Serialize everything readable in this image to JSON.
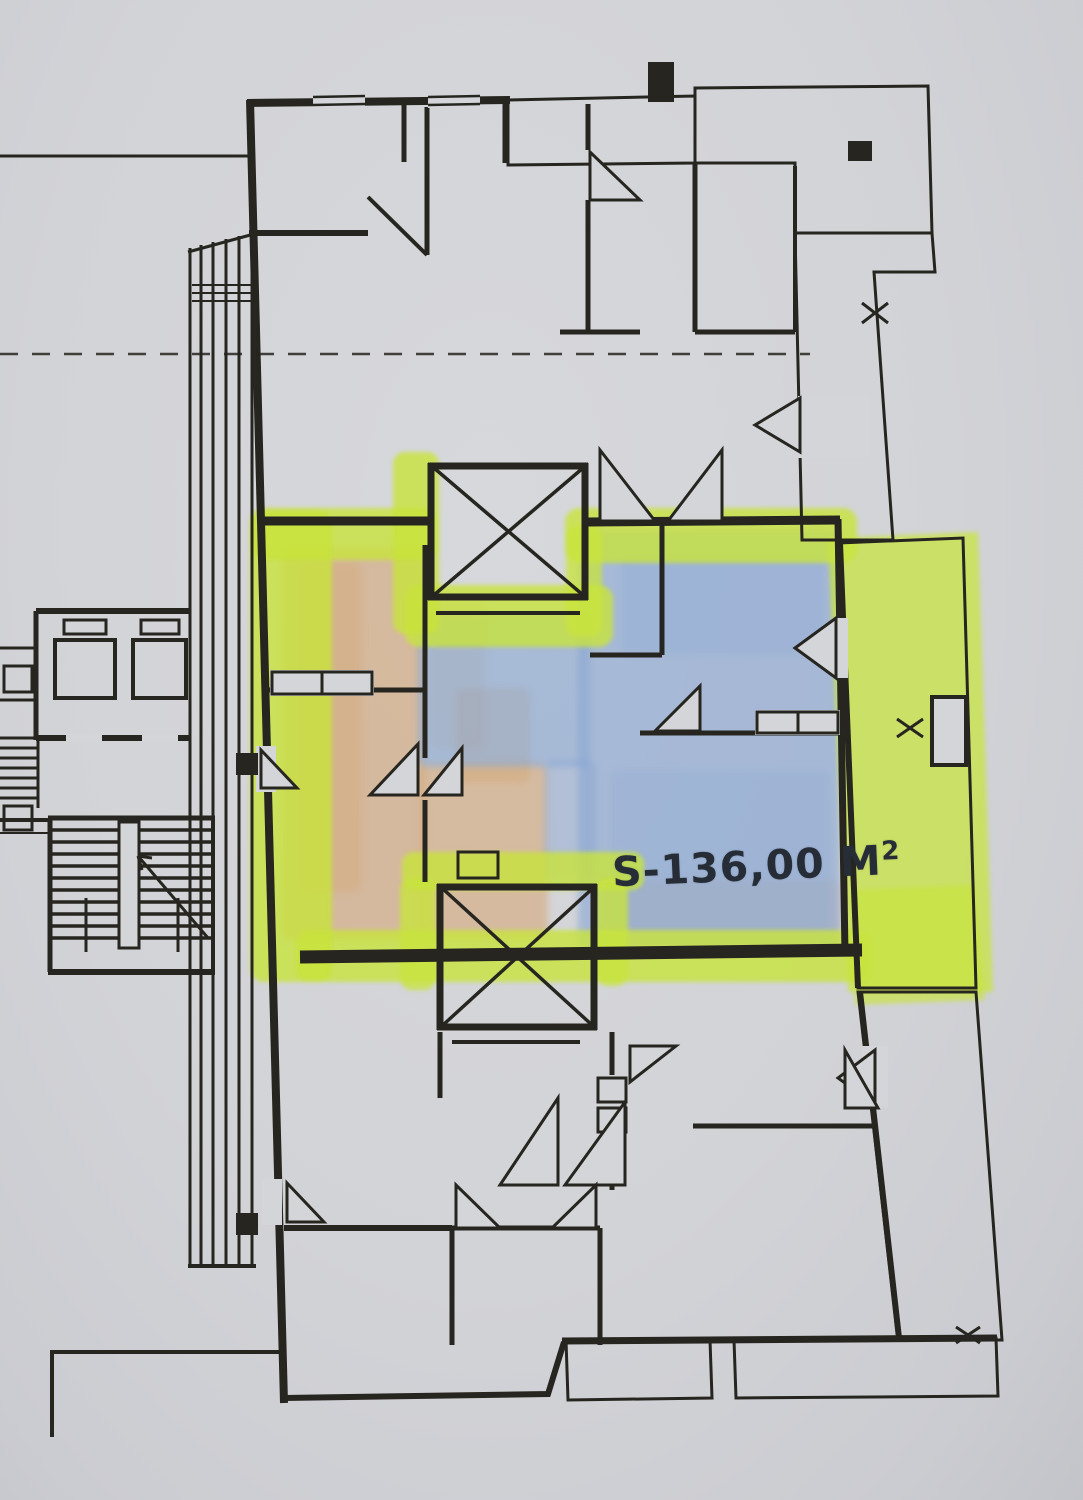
{
  "plan": {
    "area_label": "S-136,00 M",
    "area_label_exponent": "2",
    "colors": {
      "paper": "#d4d5d9",
      "ink": "#26251f",
      "highlighter": "#c8e43b",
      "pencil-blue": "#87a5d3",
      "pencil-orange": "#d5a066"
    }
  }
}
